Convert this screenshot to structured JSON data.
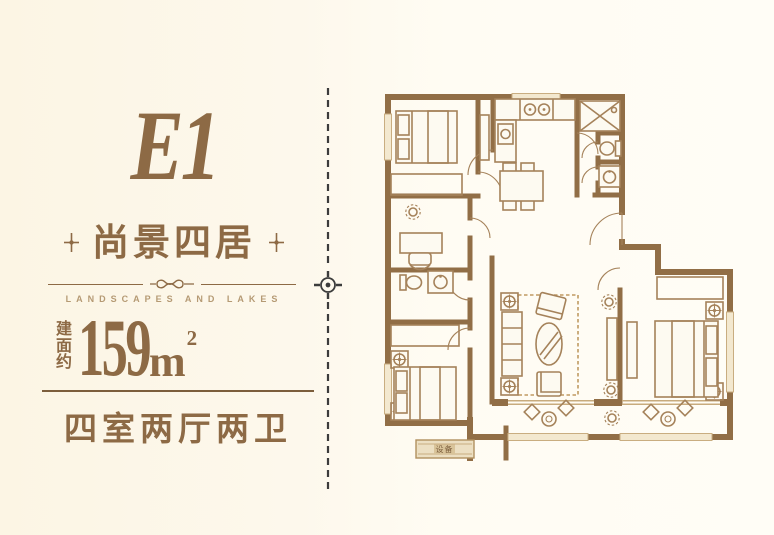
{
  "theme": {
    "brand_brown": "#8d6a45",
    "rule_brown": "#7c5e3c",
    "wall_brown": "#916e46",
    "furniture_brown": "#a5825a",
    "tagline_brown": "#b59a74",
    "divider_dark": "#3c3c3c",
    "background": "#fdf8ec"
  },
  "left_panel": {
    "unit_code": "E1",
    "unit_name": "尚景四居",
    "tagline": "LANDSCAPES AND LAKES",
    "area": {
      "prefix": "建面约",
      "value": "159",
      "unit": "m",
      "superscript": "2"
    },
    "layout": "四室两厅两卫"
  },
  "floor_plan": {
    "platform_label": "设备"
  }
}
